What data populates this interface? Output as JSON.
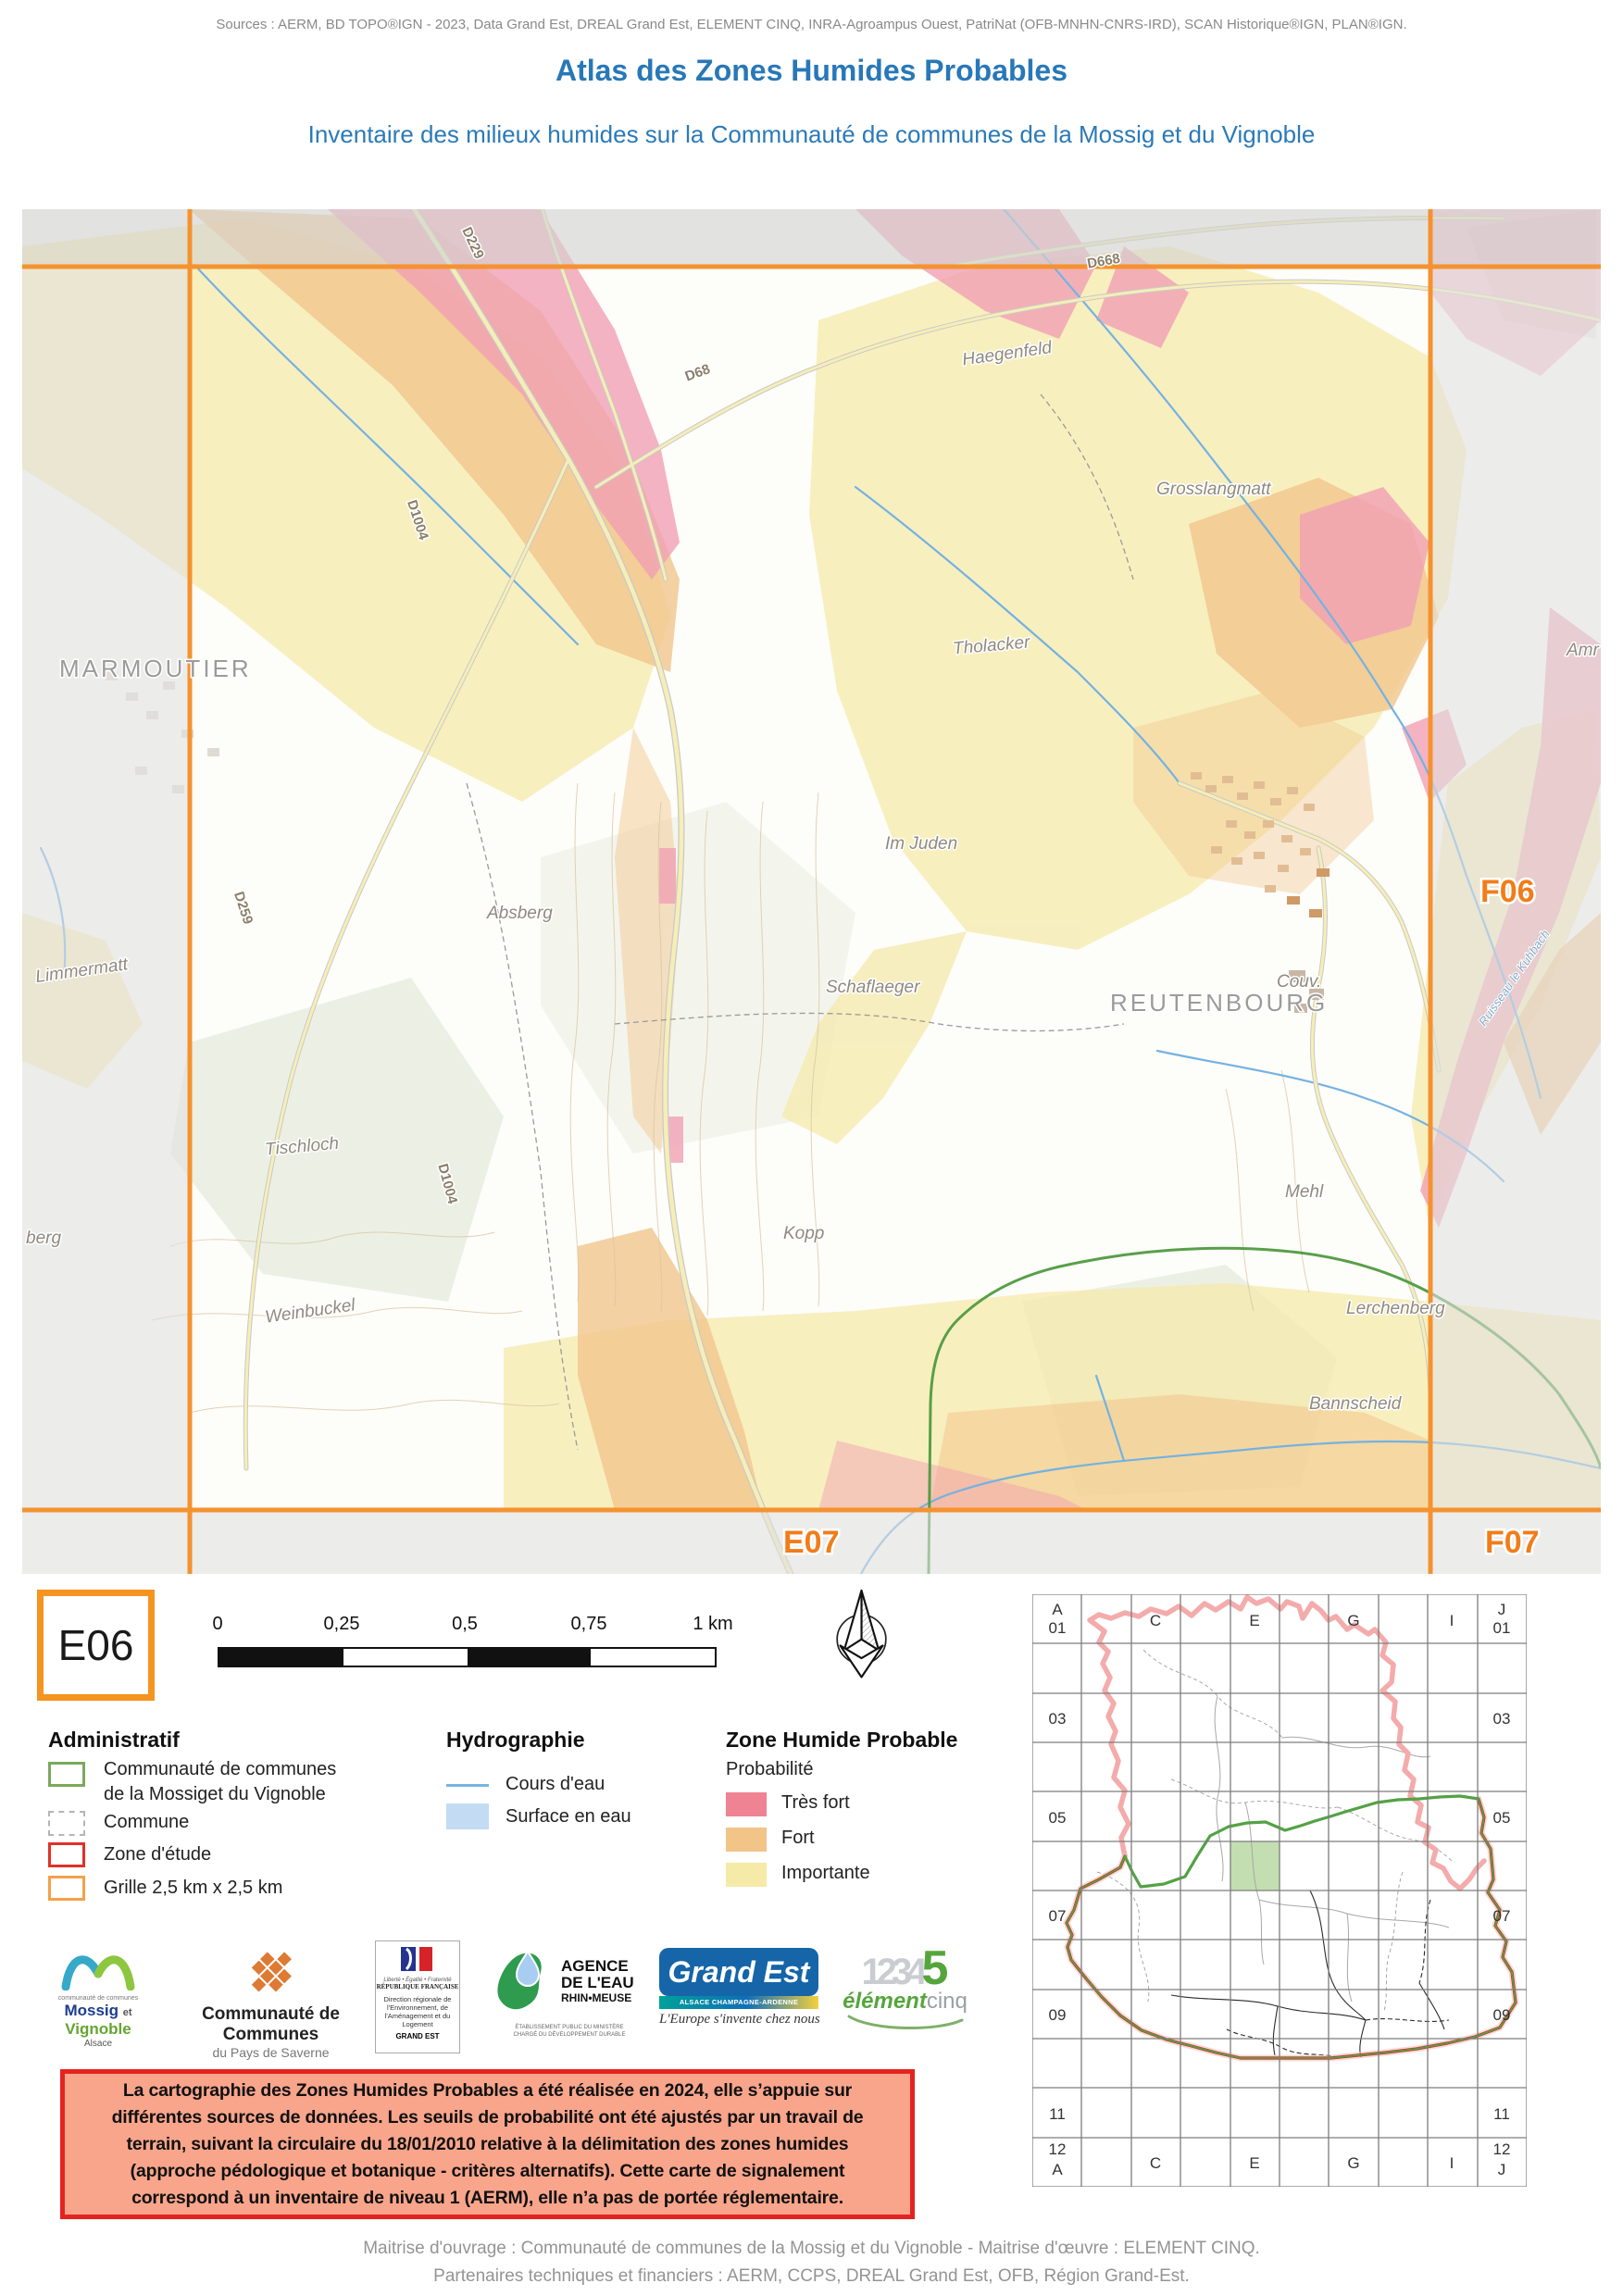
{
  "page": {
    "sources": "Sources : AERM, BD TOPO®IGN - 2023, Data Grand Est, DREAL Grand Est, ELEMENT CINQ, INRA-Agroampus Ouest, PatriNat (OFB-MNHN-CNRS-IRD), SCAN Historique®IGN, PLAN®IGN.",
    "title": "Atlas des Zones Humides Probables",
    "subtitle": "Inventaire des milieux humides sur la Communauté de communes de la Mossig et du Vignoble"
  },
  "sheet": {
    "id": "E06"
  },
  "map": {
    "grid_labels": {
      "right": "F06",
      "bottom_left": "E07",
      "bottom_right": "F07"
    },
    "places": {
      "marmoutier": "MARMOUTIER",
      "reutenbourg": "REUTENBOURG",
      "haegenfeld": "Haegenfeld",
      "grosslangmatt": "Grosslangmatt",
      "amr": "Amr",
      "tholacker": "Tholacker",
      "im_juden": "Im Juden",
      "schaflaeger": "Schaflaeger",
      "couv": "Couv.",
      "absberg": "Absberg",
      "limmermatt": "Limmermatt",
      "tischloch": "Tischloch",
      "kopp": "Kopp",
      "mehl": "Mehl",
      "weinbuckel": "Weinbuckel",
      "lerchenberg": "Lerchenberg",
      "bannscheid": "Bannscheid",
      "berg": "berg",
      "ruisseau": "Ruisseau le Kuhbach"
    },
    "roads": {
      "d229": "D229",
      "d259": "D259",
      "d1004": "D1004",
      "d1004_s": "D1004",
      "d68": "D68",
      "d668": "D668"
    }
  },
  "scalebar": {
    "t0": "0",
    "t1": "0,25",
    "t2": "0,5",
    "t3": "0,75",
    "t4": "1 km"
  },
  "legend": {
    "administratif": {
      "title": "Administratif",
      "cc_line1": "Communauté de communes",
      "cc_line2": "de la Mossiget du Vignoble",
      "commune": "Commune",
      "zone_etude": "Zone d'étude",
      "grille": "Grille 2,5 km x 2,5 km"
    },
    "hydrographie": {
      "title": "Hydrographie",
      "cours": "Cours d'eau",
      "surface": "Surface en eau"
    },
    "zhp": {
      "title": "Zone Humide Probable",
      "subtitle": "Probabilité",
      "tres_fort": "Très fort",
      "fort": "Fort",
      "importante": "Importante"
    }
  },
  "logos": {
    "mossig": {
      "small": "communauté de communes",
      "name1": "Mossig",
      "et": "et",
      "name2": "Vignoble",
      "region": "Alsace"
    },
    "saverne": {
      "line1": "Communauté de Communes",
      "line2": "du Pays de Saverne"
    },
    "rf": {
      "motto": "Liberté • Égalité • Fraternité",
      "name": "RÉPUBLIQUE FRANÇAISE",
      "dreal": "Direction régionale de l'Environnement, de l'Aménagement et du Logement",
      "ge": "GRAND EST"
    },
    "agence": {
      "l1": "AGENCE",
      "l2": "DE L'EAU",
      "l3": "RHIN•MEUSE",
      "tiny1": "ÉTABLISSEMENT PUBLIC DU MINISTÈRE",
      "tiny2": "CHARGÉ DU DÉVELOPPEMENT DURABLE"
    },
    "grandest": {
      "name": "Grand Est",
      "stripe": "ALSACE CHAMPAGNE-ARDENNE LORRAINE",
      "tagline": "L'Europe s'invente chez nous"
    },
    "element5": {
      "digits": "1234",
      "five": "5",
      "name1": "élément",
      "name2": "cinq"
    }
  },
  "warning": {
    "lines": [
      "La cartographie des Zones Humides Probables a été réalisée en 2024, elle s’appuie sur",
      "différentes sources de données. Les seuils de probabilité ont été ajustés par un travail de",
      "terrain, suivant la circulaire du 18/01/2010 relative à la délimitation des zones humides",
      "(approche pédologique et botanique - critères alternatifs). Cette carte de signalement",
      "correspond à un inventaire de niveau 1 (AERM), elle n’a pas de portée réglementaire."
    ]
  },
  "overview": {
    "corner_tl_1": "A",
    "corner_tl_2": "01",
    "corner_tr_1": "J",
    "corner_tr_2": "01",
    "corner_bl_1": "12",
    "corner_bl_2": "A",
    "corner_br_1": "12",
    "corner_br_2": "J",
    "letters": [
      "C",
      "E",
      "G",
      "I"
    ],
    "rows": [
      "03",
      "05",
      "07",
      "09",
      "11"
    ]
  },
  "footer": {
    "line1": "Maitrise d'ouvrage : Communauté de communes de la Mossig et du Vignoble - Maitrise d'œuvre : ELEMENT CINQ.",
    "line2": "Partenaires techniques et financiers : AERM, CCPS, DREAL Grand Est, OFB, Région Grand-Est."
  },
  "colors": {
    "accent_blue": "#2878b8",
    "grid_orange": "#f5922f",
    "sheet_border": "#f5941f",
    "zhp_tres_fort": "#ef8293",
    "zhp_fort": "#f2c488",
    "zhp_importante": "#f5eaa8",
    "stream_blue": "#74b2e2",
    "surface_eau": "#c3dcf3",
    "cc_green": "#7aa95c",
    "zone_etude_red": "#e03127",
    "warning_bg": "#f9a58b",
    "warning_border": "#e42320",
    "overview_pink": "#f4abab",
    "overview_green": "#53a245"
  }
}
